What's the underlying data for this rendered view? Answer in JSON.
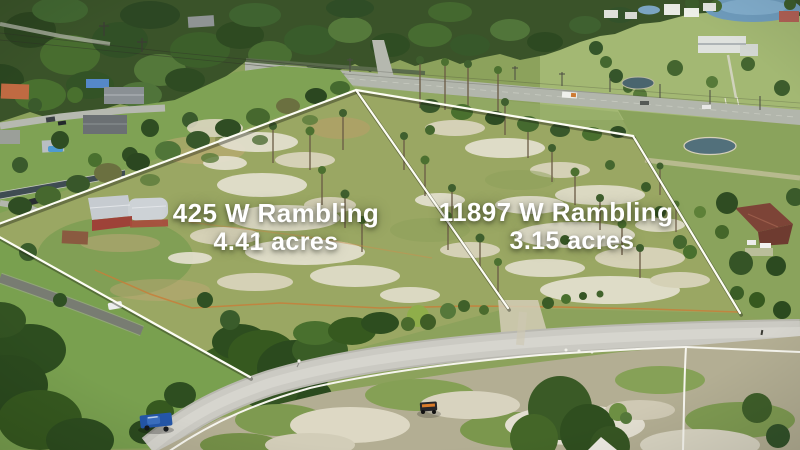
{
  "meta": {
    "type": "aerial-real-estate-photo",
    "description": "Drone aerial view of two adjacent vacant land parcels outlined in white beside a rural road"
  },
  "parcels": [
    {
      "id": "left",
      "address": "425 W Rambling",
      "acreage": "4.41 acres"
    },
    {
      "id": "right",
      "address": "11897 W Rambling",
      "acreage": "3.15 acres"
    }
  ],
  "overlay": {
    "line_color": "#fdfdf4",
    "label_text_color": "#ffffff"
  },
  "scene_colors": {
    "parcel_grass": "#9aa763",
    "lawn_green": "#7fa254",
    "trees_dark": "#3a5329",
    "sand": "#e6e2d2",
    "road": "#cbcac3",
    "highway": "#b2b6ac",
    "lake": "#6f9cbd",
    "pond": "#52707b",
    "barn_roof": "#c6cbd0",
    "barn_wall": "#9e4238",
    "truck_blue": "#2456a8",
    "fence_orange": "#c77f3a",
    "fence_white": "#f6f5ee"
  }
}
